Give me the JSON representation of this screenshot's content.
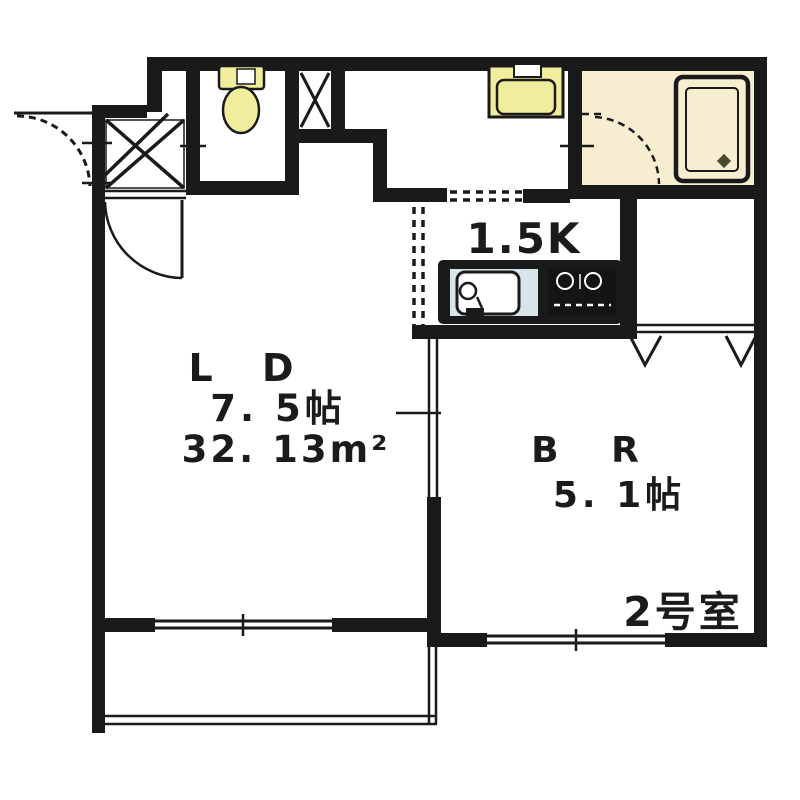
{
  "floorplan": {
    "kitchen": {
      "label": "1.5K"
    },
    "living_dining": {
      "label": "L D",
      "size": "7. 5帖",
      "area_value": "32. 13",
      "area_unit": "m²"
    },
    "bedroom": {
      "label": "B R",
      "size": "5. 1帖"
    },
    "room_number": "2号室",
    "fixtures": [
      "toilet",
      "washing-machine-pan",
      "bathtub",
      "kitchen-sink",
      "gas-stove",
      "folding-closet-doors",
      "sliding-door",
      "sliding-windows",
      "entrance-door",
      "bathroom-door"
    ],
    "colors": {
      "wall": "#1a1a1a",
      "bathroom_floor": "#f7eed2",
      "fixture_yellow": "#f0ee9c",
      "sink_panel_blue": "#d7e5e9",
      "stove_black": "#141414",
      "text": "#1b1b1b",
      "background": "#ffffff"
    }
  }
}
